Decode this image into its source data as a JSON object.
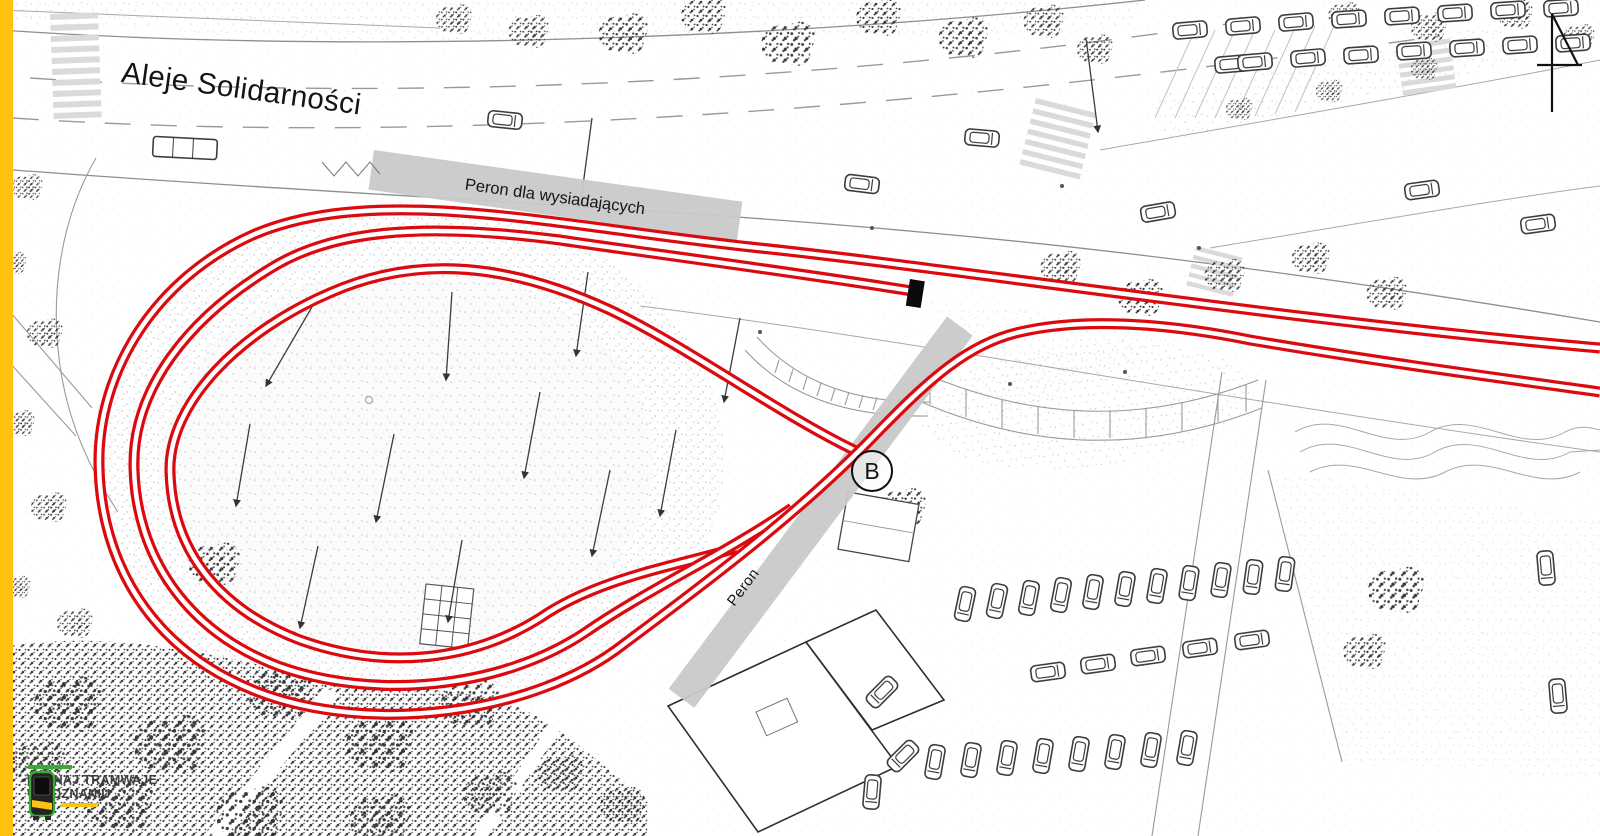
{
  "map": {
    "street_label": "Aleje Solidarności",
    "alighting_platform_label": "Peron dla wysiadających",
    "boarding_platform_label": "Peron",
    "stop_badge": "B"
  },
  "logo": {
    "line1": "POZNAJ TRAMWAJE",
    "line2": "W POZNANIU"
  },
  "icons": [
    "north-arrow-icon",
    "buffer-stop-icon",
    "tram-logo-icon"
  ],
  "colors": {
    "track-red": "#db0a0f",
    "edge-yellow": "#ffc20e",
    "platform-gray": "#c9c9c9",
    "ink": "#141414",
    "logo-green": "#3aaa35",
    "logo-yellow": "#ffc20e",
    "logo-text": "#3e3e3e"
  }
}
